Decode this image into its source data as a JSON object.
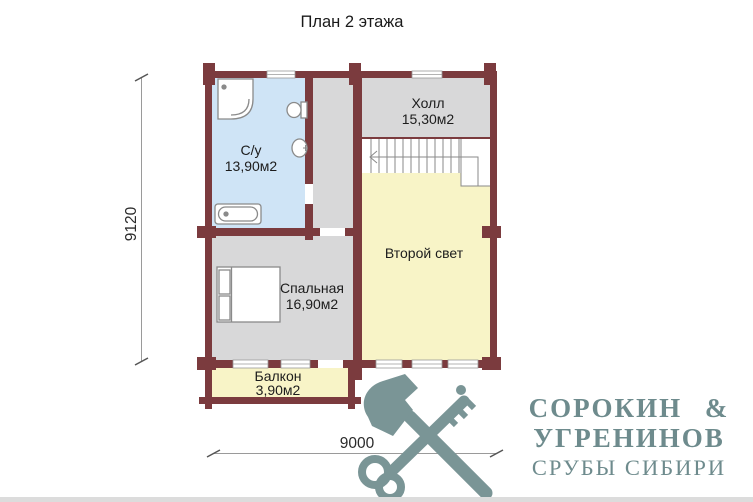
{
  "title": "План 2 этажа",
  "plan": {
    "rooms": {
      "bathroom": {
        "name": "С/у",
        "area": "13,90м2",
        "floor_color": "#cfe4f6"
      },
      "hall": {
        "name": "Холл",
        "area": "15,30м2",
        "floor_color": "#d8d8d9"
      },
      "void": {
        "name": "Второй свет",
        "floor_color": "#f8f4c7"
      },
      "bedroom": {
        "name": "Спальная",
        "area": "16,90м2",
        "floor_color": "#d8d8d9"
      },
      "balcony": {
        "name": "Балкон",
        "area": "3,90м2",
        "floor_color": "#f8f4c7"
      }
    },
    "dimensions": {
      "vertical": "9120",
      "horizontal": "9000"
    },
    "colors": {
      "wall": "#7b3b3e",
      "fixture_outline": "#8a8a8a",
      "dimension_line": "#9a9a9a"
    }
  },
  "logo": {
    "icon": "crossed-axe-and-key",
    "icon_color": "#7a9596",
    "text_color": "#6e8b8d",
    "name_line1": "СОРОКИН &",
    "name_line2": "УГРЕНИНОВ",
    "tagline": "СРУБЫ СИБИРИ"
  }
}
